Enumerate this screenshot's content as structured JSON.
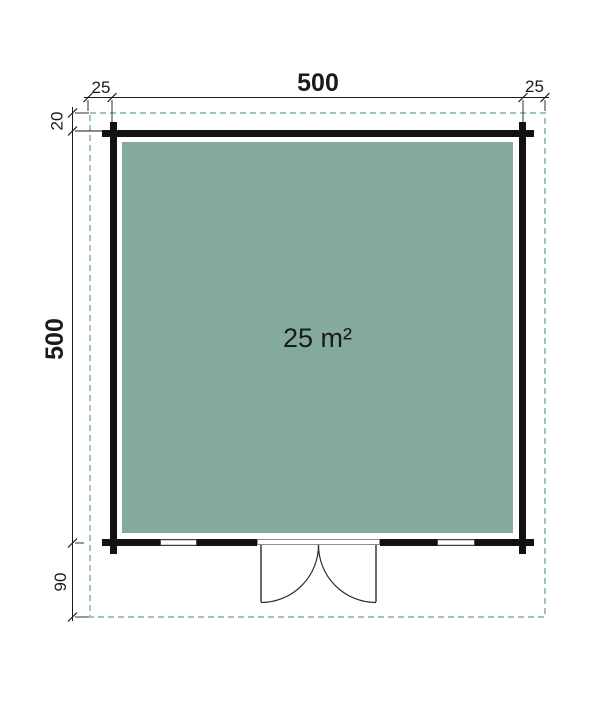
{
  "plan": {
    "area_label": "25 m²",
    "dimensions": {
      "top": {
        "left_offset": "25",
        "width": "500",
        "right_offset": "25"
      },
      "left": {
        "top_offset": "20",
        "height": "500",
        "bottom_offset": "90"
      }
    },
    "colors": {
      "floor_fill": "#84AA9C",
      "overhang_dash": "#9EC5B6",
      "wall": "#121212",
      "dimension_line": "#1a1a1a",
      "area_text": "#FFFFFF"
    }
  }
}
